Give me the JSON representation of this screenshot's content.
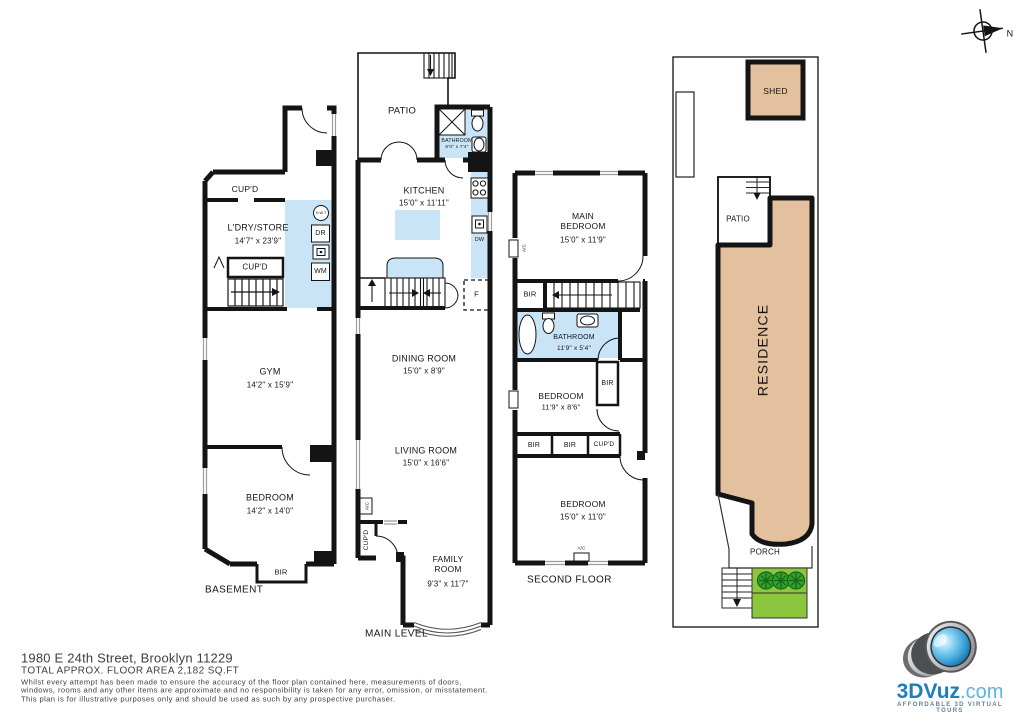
{
  "compass": {
    "north": "N"
  },
  "basement": {
    "floor_label": "BASEMENT",
    "cupd_top": "CUP'D",
    "laundry_store": "L'DRY/STORE",
    "laundry_store_dim": "14'7\" x 23'9\"",
    "cupd_mid": "CUP'D",
    "water_heater": "H.W.T",
    "dryer": "DR",
    "washer": "WM",
    "gym": "GYM",
    "gym_dim": "14'2\" x 15'9\"",
    "bedroom": "BEDROOM",
    "bedroom_dim": "14'2\" x 14'0\"",
    "bir": "BIR"
  },
  "main_level": {
    "floor_label": "MAIN LEVEL",
    "patio": "PATIO",
    "bathroom": "BATHROOM",
    "bathroom_dim": "6'0\" x 7'4\"",
    "kitchen": "KITCHEN",
    "kitchen_dim": "15'0\" x 11'11\"",
    "dishwasher": "DW",
    "fridge": "F",
    "dining_room": "DINING ROOM",
    "dining_room_dim": "15'0\" x 8'9\"",
    "living_room": "LIVING ROOM",
    "living_room_dim": "15'0\" x 16'6\"",
    "ac": "A/C",
    "cupd": "CUP'D",
    "family_room": "FAMILY ROOM",
    "family_room_dim": "9'3\" x 11'7\""
  },
  "second_floor": {
    "floor_label": "SECOND FLOOR",
    "main_bedroom": "MAIN BEDROOM",
    "main_bedroom_dim": "15'0\" x 11'9\"",
    "ac_left": "A/C",
    "bir_stairs": "BIR",
    "bathroom": "BATHROOM",
    "bathroom_dim": "11'9\" x 5'4\"",
    "bedroom_mid": "BEDROOM",
    "bedroom_mid_dim": "11'9\" x 8'6\"",
    "bir_mid": "BIR",
    "bir_row_1": "BIR",
    "bir_row_2": "BIR",
    "cupd": "CUP'D",
    "bedroom_rear": "BEDROOM",
    "bedroom_rear_dim": "15'0\" x 11'0\"",
    "ac_bottom": "A/C"
  },
  "site_plan": {
    "shed": "SHED",
    "patio": "PATIO",
    "residence": "RESIDENCE",
    "porch": "PORCH"
  },
  "footer": {
    "address": "1980 E 24th Street, Brooklyn 11229",
    "area": "TOTAL APPROX. FLOOR AREA 2,182 SQ.FT",
    "disclaimer_line1": "Whilst every attempt has been made to ensure the accuracy of the floor plan contained here, measurements of doors,",
    "disclaimer_line2": "windows, rooms and any other items are approximate and no responsibility is taken for any error, omission, or misstatement.",
    "disclaimer_line3": "This plan is for illustrative purposes only and should be used as such by any prospective purchaser."
  },
  "logo": {
    "brand": "3DVuz",
    "brand_suffix": ".com",
    "tagline": "AFFORDABLE 3D VIRTUAL TOURS"
  },
  "colors": {
    "wet_area_blue": "#c9e4f7",
    "residence_tan": "#e3c19f",
    "grass_green": "#8cc63e",
    "bush_green": "#33a02c",
    "wall_black": "#141414",
    "footer_gray": "#3e3f41",
    "logo_blue": "#1d7dbf"
  }
}
